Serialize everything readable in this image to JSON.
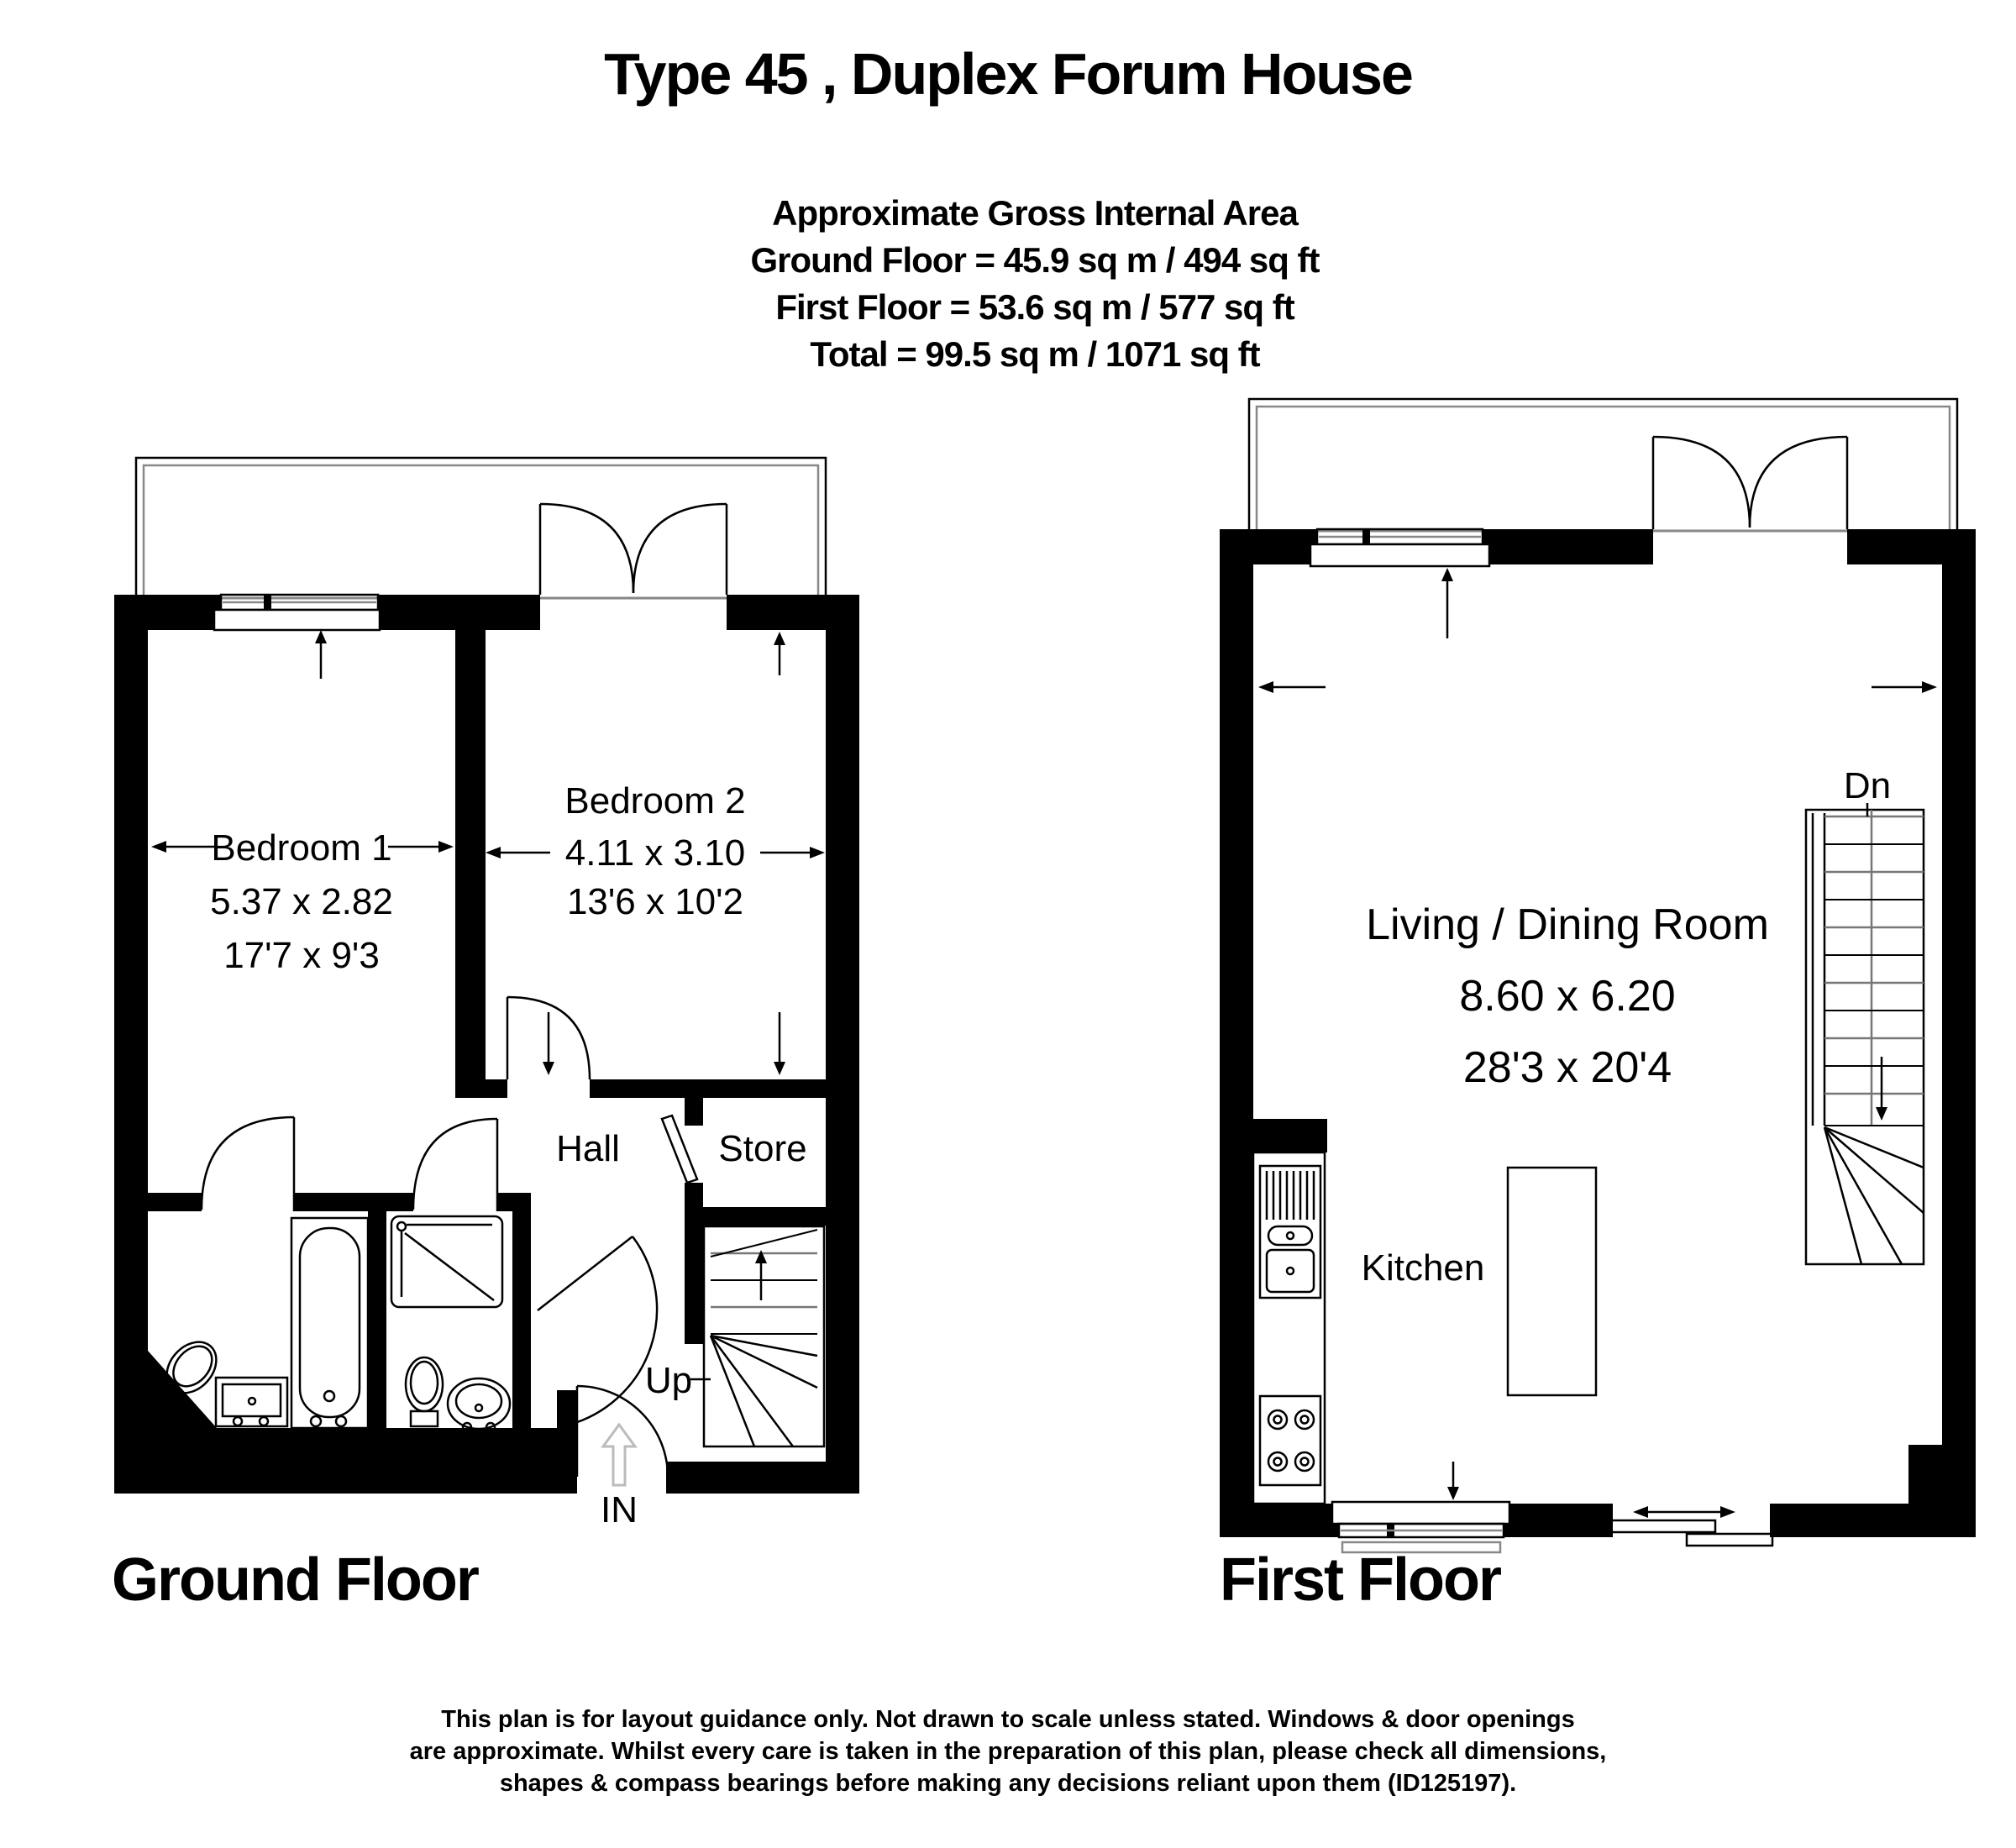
{
  "title": "Type 45 , Duplex Forum House",
  "area_summary": {
    "heading": "Approximate Gross Internal Area",
    "ground": "Ground Floor = 45.9 sq m / 494 sq ft",
    "first": "First Floor = 53.6 sq m / 577 sq ft",
    "total": "Total =  99.5 sq m / 1071 sq ft"
  },
  "ground_floor": {
    "label": "Ground Floor",
    "bedroom1": {
      "name": "Bedroom 1",
      "metric": "5.37 x 2.82",
      "imperial": "17'7 x 9'3"
    },
    "bedroom2": {
      "name": "Bedroom 2",
      "metric": "4.11 x 3.10",
      "imperial": "13'6 x 10'2"
    },
    "hall": "Hall",
    "store": "Store",
    "stairs": "Up",
    "entrance": "IN"
  },
  "first_floor": {
    "label": "First Floor",
    "living": {
      "name": "Living / Dining Room",
      "metric": "8.60 x 6.20",
      "imperial": "28'3 x 20'4"
    },
    "kitchen": "Kitchen",
    "stairs": "Dn"
  },
  "disclaimer": {
    "line1": "This plan is for layout guidance only. Not drawn to scale unless stated. Windows & door openings",
    "line2": "are approximate. Whilst every care is taken in the preparation of this plan, please check all dimensions,",
    "line3": "shapes & compass bearings before making any decisions reliant upon them (ID125197)."
  },
  "colors": {
    "wall": "#000000",
    "background": "#ffffff",
    "balcony_line": "#888888",
    "entry_arrow": "#bbbbbb"
  }
}
